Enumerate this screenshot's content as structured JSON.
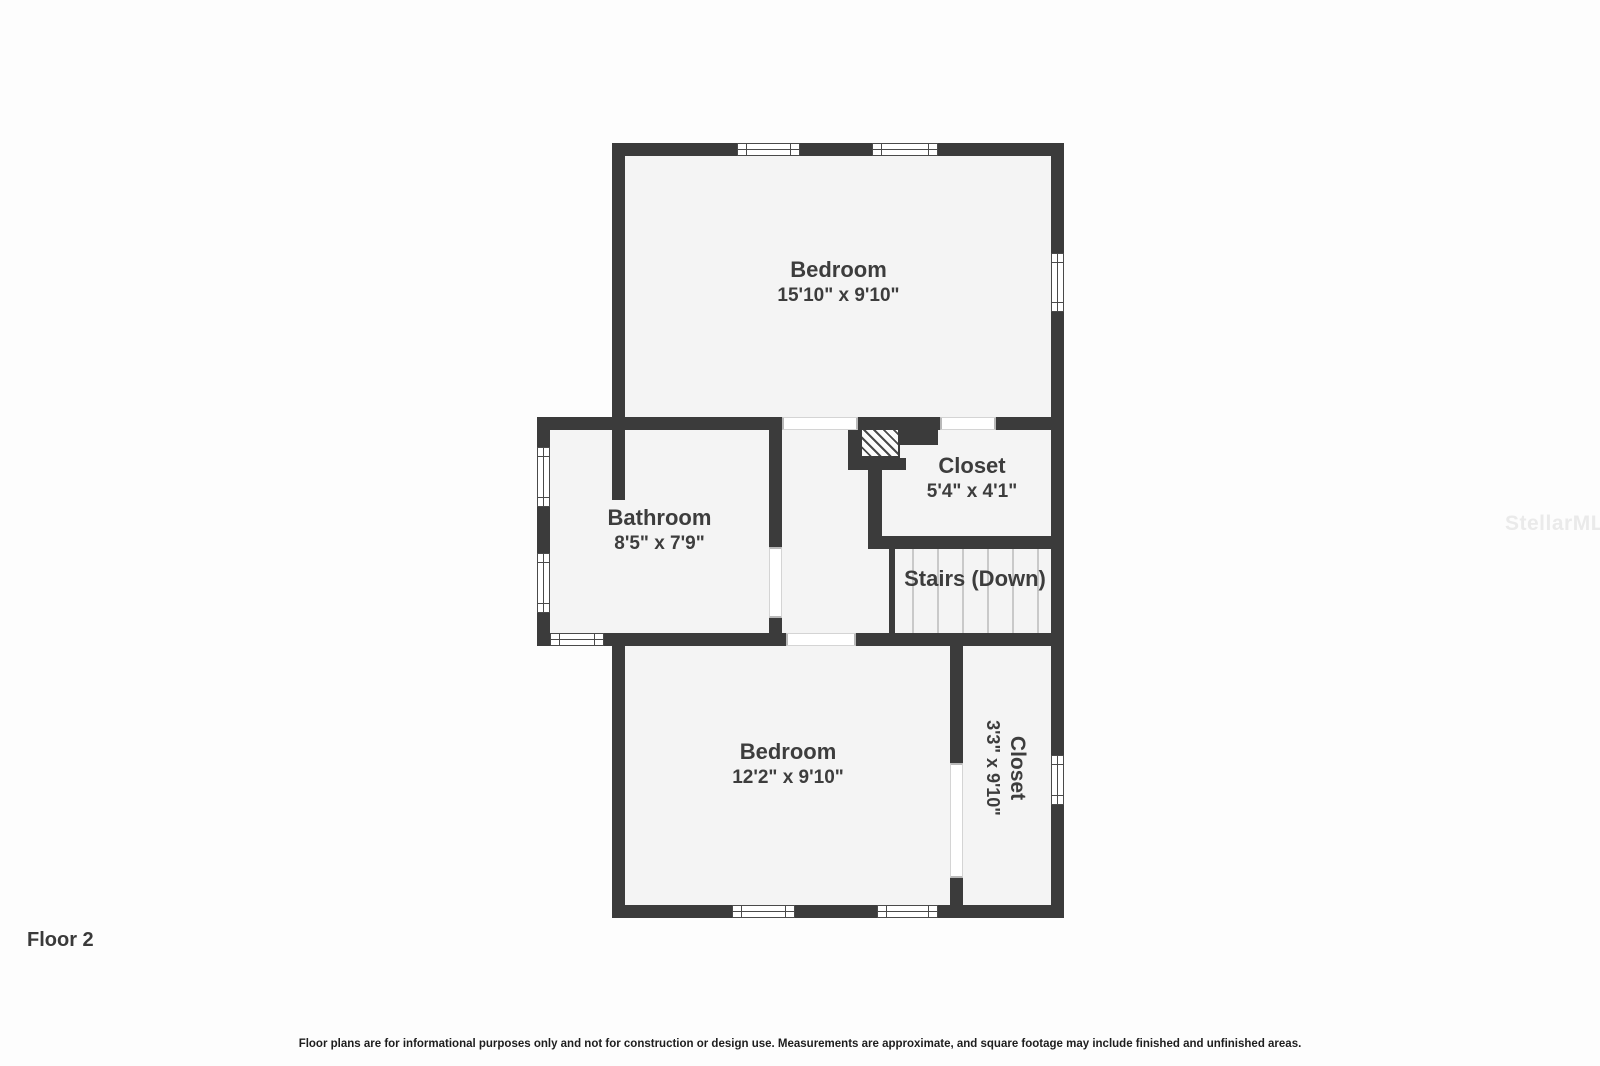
{
  "page": {
    "floor_label": "Floor 2",
    "disclaimer": "Floor plans are for informational purposes only and not for construction or design use. Measurements are approximate, and square footage may include finished and unfinished areas.",
    "watermark": "StellarMLS"
  },
  "rooms": {
    "bedroom_top": {
      "name": "Bedroom",
      "dims": "15'10\" x 9'10\""
    },
    "bathroom": {
      "name": "Bathroom",
      "dims": "8'5\" x 7'9\""
    },
    "closet_top": {
      "name": "Closet",
      "dims": "5'4\" x 4'1\""
    },
    "stairs": {
      "name": "Stairs (Down)"
    },
    "bedroom_bottom": {
      "name": "Bedroom",
      "dims": "12'2\" x 9'10\""
    },
    "closet_bottom": {
      "name": "Closet",
      "dims": "3'3\" x 9'10\""
    }
  },
  "colors": {
    "wall": "#3b3b3b",
    "room_fill": "#f4f4f4",
    "text": "#3d3d3d",
    "watermark": "#eaeaea"
  }
}
